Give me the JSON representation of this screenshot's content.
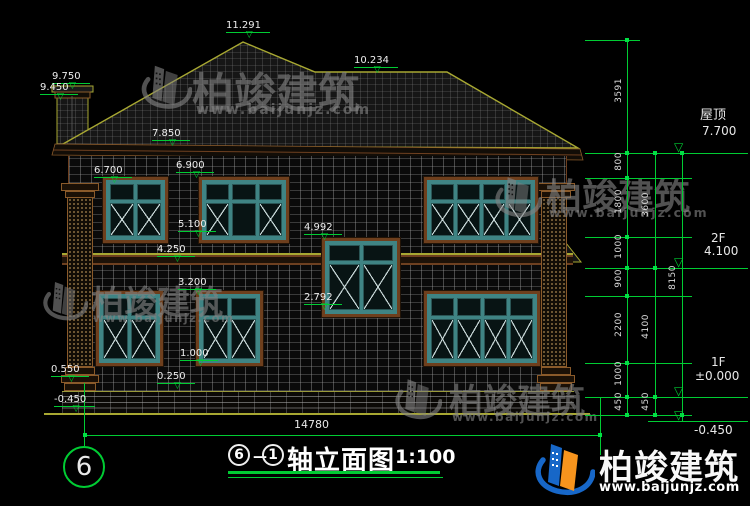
{
  "meta": {
    "drawing_type": "architectural elevation",
    "background": "#000000"
  },
  "colors": {
    "annotation_green": "#00cc33",
    "roof_outline": "#a8a832",
    "trim_brown": "#6e3f1d",
    "window_frame_teal": "#3f8484",
    "brand_blue": "#1767c8",
    "brand_orange": "#f7941d"
  },
  "title": {
    "axis_start": "6",
    "separator": "—",
    "axis_end": "1",
    "text": "轴立面图",
    "scale": "1:100"
  },
  "axis_bubble": "6",
  "watermark": {
    "name": "柏竣建筑",
    "url": "www.baijunjz.com"
  },
  "brand": {
    "name": "柏竣建筑",
    "url": "www.baijunjz.com"
  },
  "annotations": {
    "levels": [
      {
        "v": "11.291",
        "x": 226,
        "y": 20
      },
      {
        "v": "10.234",
        "x": 354,
        "y": 55
      },
      {
        "v": "9.750",
        "x": 52,
        "y": 71
      },
      {
        "v": "9.450",
        "x": 40,
        "y": 82
      },
      {
        "v": "7.850",
        "x": 152,
        "y": 128
      },
      {
        "v": "6.900",
        "x": 176,
        "y": 160
      },
      {
        "v": "6.700",
        "x": 94,
        "y": 165
      },
      {
        "v": "5.100",
        "x": 178,
        "y": 219
      },
      {
        "v": "4.992",
        "x": 304,
        "y": 222
      },
      {
        "v": "4.250",
        "x": 157,
        "y": 244
      },
      {
        "v": "3.200",
        "x": 178,
        "y": 277
      },
      {
        "v": "2.792",
        "x": 304,
        "y": 292
      },
      {
        "v": "1.000",
        "x": 180,
        "y": 348
      },
      {
        "v": "0.550",
        "x": 51,
        "y": 364
      },
      {
        "v": "0.250",
        "x": 157,
        "y": 371
      },
      {
        "v": "-0.450",
        "x": 54,
        "y": 394
      }
    ],
    "hlines": [
      {
        "x": 585,
        "y": 40,
        "w": 55
      },
      {
        "x": 585,
        "y": 153,
        "w": 163
      },
      {
        "x": 585,
        "y": 178,
        "w": 107
      },
      {
        "x": 585,
        "y": 237,
        "w": 107
      },
      {
        "x": 585,
        "y": 268,
        "w": 163
      },
      {
        "x": 585,
        "y": 296,
        "w": 107
      },
      {
        "x": 585,
        "y": 363,
        "w": 107
      },
      {
        "x": 585,
        "y": 397,
        "w": 163
      },
      {
        "x": 585,
        "y": 415,
        "w": 107
      },
      {
        "x": 648,
        "y": 421,
        "w": 100
      },
      {
        "x": 85,
        "y": 435,
        "w": 515
      }
    ],
    "vlines": [
      {
        "x": 627,
        "y": 40,
        "h": 375
      },
      {
        "x": 655,
        "y": 153,
        "h": 262
      },
      {
        "x": 682,
        "y": 153,
        "h": 268
      },
      {
        "x": 84,
        "y": 383,
        "h": 63
      },
      {
        "x": 600,
        "y": 398,
        "h": 57
      }
    ],
    "ticks": [
      {
        "x": 627,
        "y": 40
      },
      {
        "x": 627,
        "y": 153
      },
      {
        "x": 627,
        "y": 178
      },
      {
        "x": 627,
        "y": 237
      },
      {
        "x": 627,
        "y": 268
      },
      {
        "x": 627,
        "y": 296
      },
      {
        "x": 627,
        "y": 363
      },
      {
        "x": 627,
        "y": 397
      },
      {
        "x": 627,
        "y": 415
      },
      {
        "x": 655,
        "y": 153
      },
      {
        "x": 655,
        "y": 268
      },
      {
        "x": 655,
        "y": 397
      },
      {
        "x": 655,
        "y": 415
      },
      {
        "x": 682,
        "y": 153
      },
      {
        "x": 682,
        "y": 415
      },
      {
        "x": 85,
        "y": 435
      },
      {
        "x": 600,
        "y": 435
      }
    ],
    "rot_labels": [
      {
        "v": "3591",
        "x": 614,
        "cy": 96
      },
      {
        "v": "800",
        "x": 614,
        "cy": 165
      },
      {
        "v": "1800",
        "x": 614,
        "cy": 207
      },
      {
        "v": "1000",
        "x": 614,
        "cy": 252
      },
      {
        "v": "900",
        "x": 614,
        "cy": 282
      },
      {
        "v": "2200",
        "x": 614,
        "cy": 330
      },
      {
        "v": "1000",
        "x": 614,
        "cy": 379
      },
      {
        "v": "450",
        "x": 614,
        "cy": 405
      },
      {
        "v": "3600",
        "x": 641,
        "cy": 210
      },
      {
        "v": "4100",
        "x": 641,
        "cy": 332
      },
      {
        "v": "450",
        "x": 641,
        "cy": 405
      },
      {
        "v": "8150",
        "x": 668,
        "cy": 283
      }
    ],
    "flag_triangles": [
      {
        "x": 674,
        "y": 141
      },
      {
        "x": 674,
        "y": 256
      },
      {
        "x": 674,
        "y": 385
      },
      {
        "x": 674,
        "y": 409
      }
    ],
    "texts": [
      {
        "v": "屋顶",
        "x": 700,
        "y": 109,
        "s": 13
      },
      {
        "v": "7.700",
        "x": 702,
        "y": 125,
        "s": 12
      },
      {
        "v": "2F",
        "x": 711,
        "y": 232,
        "s": 12
      },
      {
        "v": "4.100",
        "x": 704,
        "y": 245,
        "s": 12
      },
      {
        "v": "1F",
        "x": 711,
        "y": 356,
        "s": 12
      },
      {
        "v": "±0.000",
        "x": 695,
        "y": 370,
        "s": 12
      },
      {
        "v": "-0.450",
        "x": 694,
        "y": 424,
        "s": 12
      },
      {
        "v": "14780",
        "x": 294,
        "y": 419,
        "s": 11
      }
    ]
  }
}
